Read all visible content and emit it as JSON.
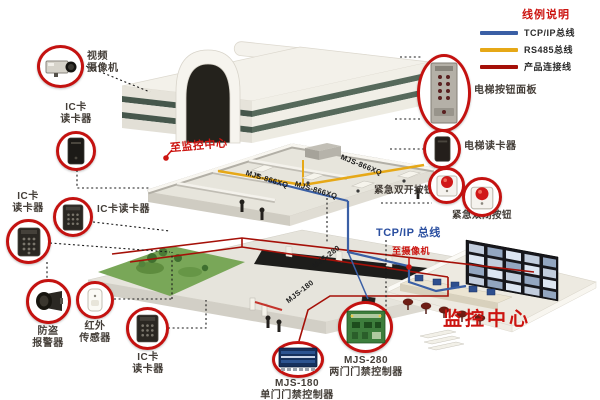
{
  "legend": {
    "title": "线例说明",
    "items": [
      {
        "label": "TCP/IP总线",
        "color": "#3a5fa5"
      },
      {
        "label": "RS485总线",
        "color": "#e6a817"
      },
      {
        "label": "产品连接线",
        "color": "#a51008"
      }
    ]
  },
  "device_labels": {
    "video_camera": "视频\n摄像机",
    "ic_reader_top": "IC卡\n读卡器",
    "ic_reader_left": "IC卡\n读卡器",
    "ic_reader_mid": "IC卡读卡器",
    "burglar_alarm": "防盗\n报警器",
    "infrared_sensor": "红外\n传感器",
    "ic_reader_bottom": "IC卡\n读卡器",
    "elevator_panel": "电梯按钮面板",
    "elevator_reader": "电梯读卡器",
    "emergency_open": "紧急双开按钮",
    "emergency_close": "紧急双闭按钮"
  },
  "controllers": {
    "mjs180": "MJS-180\n单门门禁控制器",
    "mjs280": "MJS-280\n两门门禁控制器"
  },
  "annotations": {
    "to_monitoring_center": "至监控中心",
    "to_camera": "至摄像机",
    "tcpip_bus": "TCP/IP 总线",
    "monitoring_center": "监控中心",
    "floor_label_1": "MJS-866XQ",
    "floor_label_2": "MJS-866XQ",
    "floor_label_3": "MJS-866XQ",
    "line_label_mjs280": "MJS-280",
    "line_label_mjs180": "MJS-180"
  },
  "colors": {
    "accent_red": "#cc1410",
    "line_blue": "#3a5fa5",
    "line_yellow": "#e6a817",
    "line_dark_red": "#a51008",
    "glass_green": "#4d5f54"
  }
}
